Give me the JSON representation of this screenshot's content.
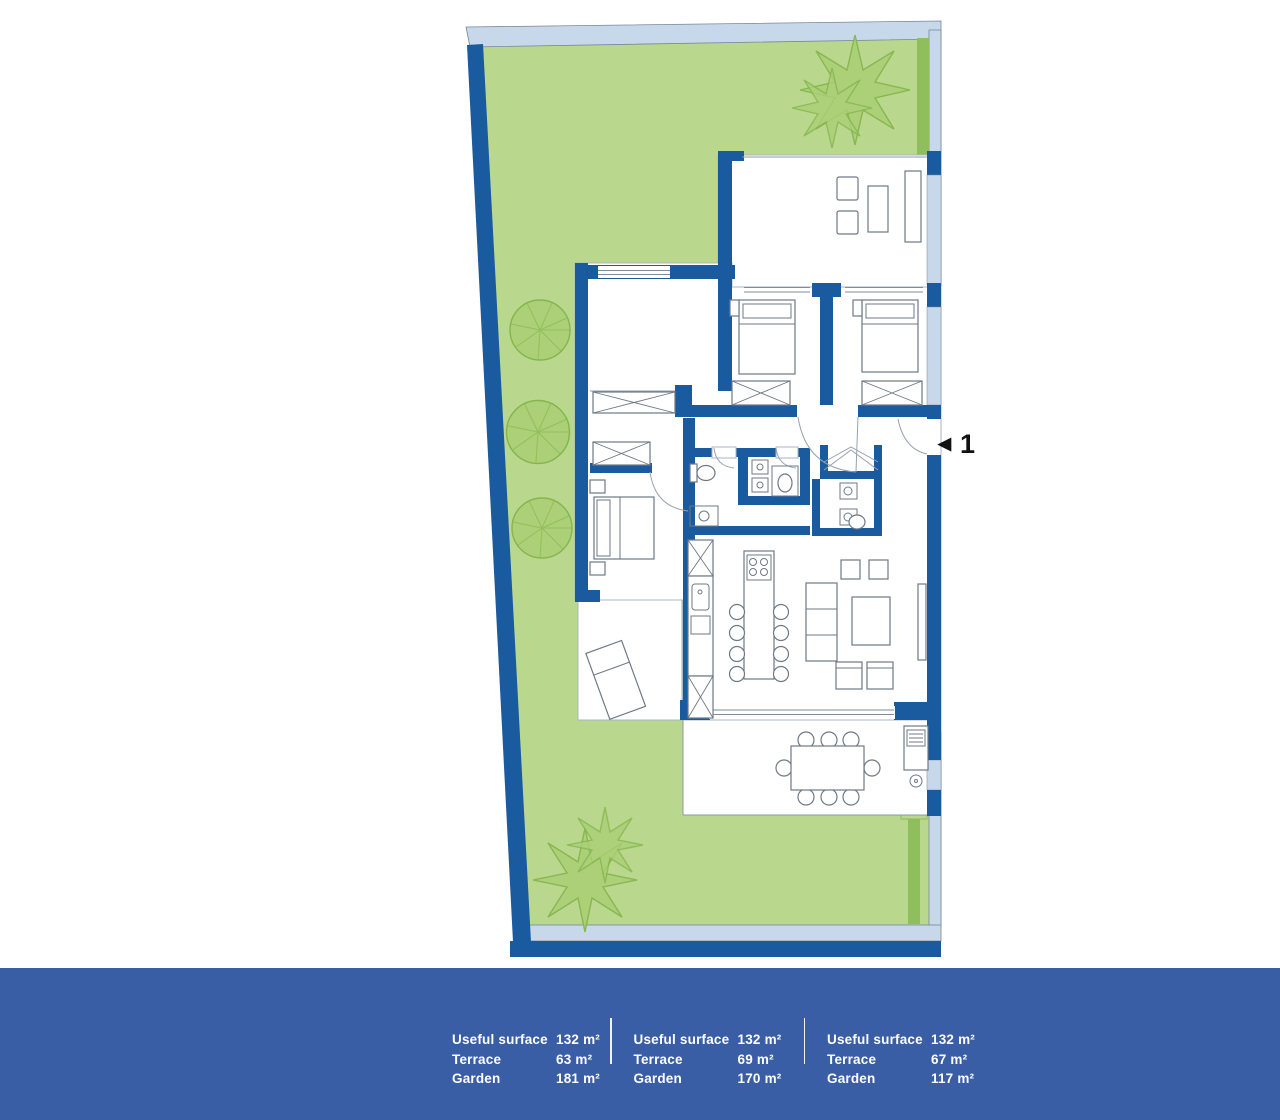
{
  "plan": {
    "unit_marker": {
      "arrow": "◀",
      "label": "1"
    }
  },
  "footer": {
    "columns": [
      {
        "rows": [
          {
            "label": "Useful surface",
            "value": "132 m²"
          },
          {
            "label": "Terrace",
            "value": "63 m²"
          },
          {
            "label": "Garden",
            "value": "181 m²"
          }
        ]
      },
      {
        "rows": [
          {
            "label": "Useful surface",
            "value": "132 m²"
          },
          {
            "label": "Terrace",
            "value": "69 m²"
          },
          {
            "label": "Garden",
            "value": "170 m²"
          }
        ]
      },
      {
        "rows": [
          {
            "label": "Useful surface",
            "value": "132 m²"
          },
          {
            "label": "Terrace",
            "value": "67 m²"
          },
          {
            "label": "Garden",
            "value": "117 m²"
          }
        ]
      }
    ]
  },
  "colors": {
    "wall_blue": "#1a5a9e",
    "light_blue": "#c6d8ea",
    "garden_green": "#b9d78d",
    "hedge_green": "#8fbe5d",
    "tree_green": "#abd077",
    "tree_stroke": "#86b54e",
    "footer_blue": "#3a5ea6",
    "marker_black": "#111111"
  }
}
